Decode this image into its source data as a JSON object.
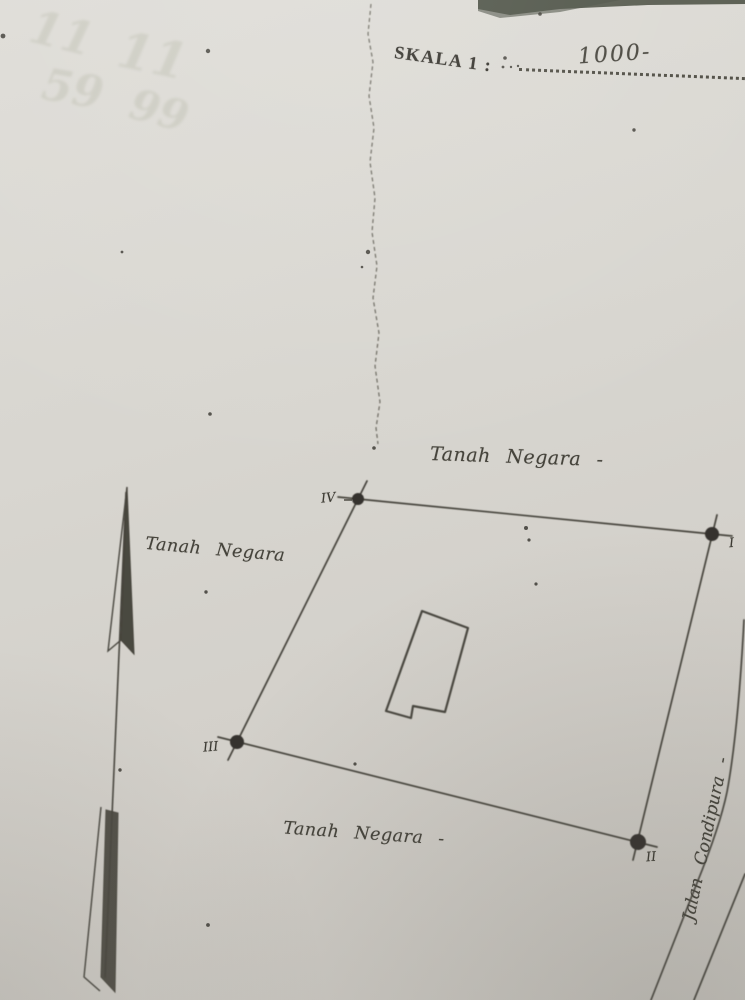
{
  "colors": {
    "paper": "#d8d5cf",
    "print_ink": "#33312b",
    "drawing_ink": "#46443c",
    "photo_background_band": "#565a4e"
  },
  "header": {
    "scale_label": "SKALA 1 :",
    "scale_value_handwritten": "1000-"
  },
  "sketch": {
    "land_labels": {
      "top": "Tanah Negara -",
      "left": "Tanah Negara",
      "bottom": "Tanah Negara -"
    },
    "road_label": "Jalan Condipura -",
    "boundary_points": [
      {
        "numeral": "I"
      },
      {
        "numeral": "II"
      },
      {
        "numeral": "III"
      },
      {
        "numeral": "IV"
      }
    ]
  },
  "artifacts": {
    "ghost_digits": [
      "11",
      "11",
      "59",
      "99"
    ]
  }
}
